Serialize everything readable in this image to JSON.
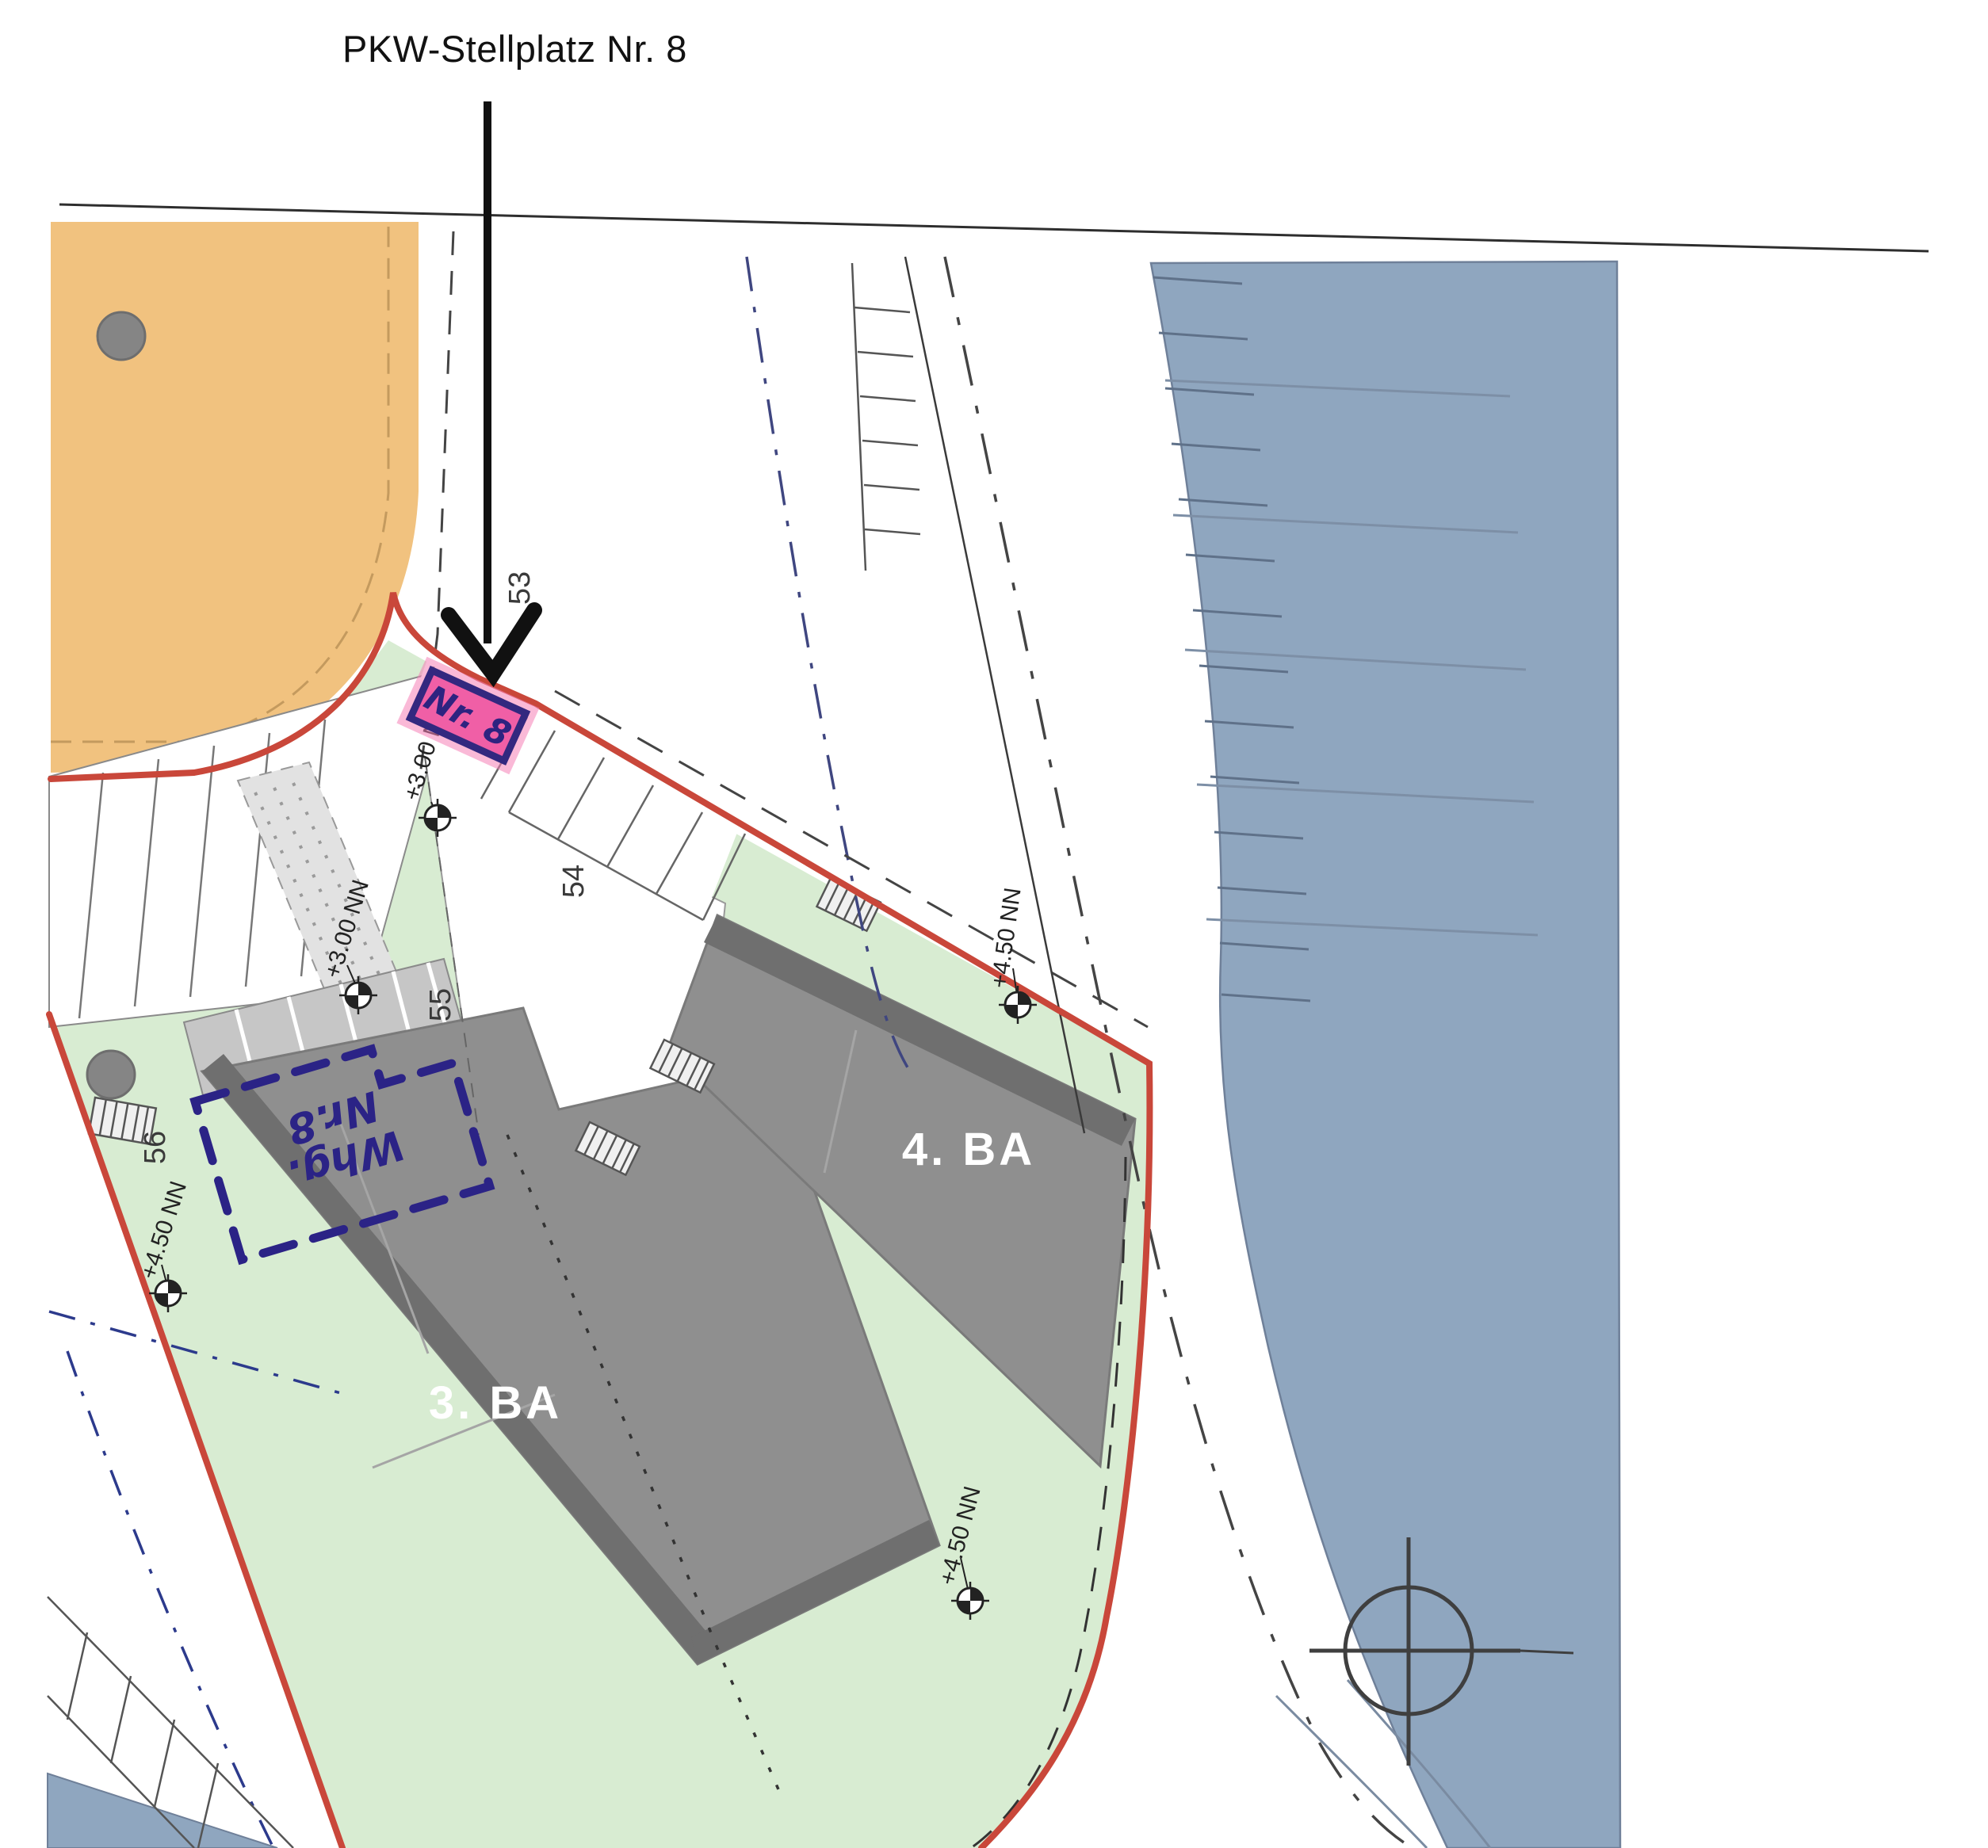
{
  "annotation": {
    "title": "PKW-Stellplatz Nr. 8",
    "stall_label": "Nr. 8",
    "apartment": {
      "line1": "Whg.",
      "line2": "Nr.8"
    }
  },
  "plan": {
    "phases": {
      "ba3": "3. BA",
      "ba4": "4. BA"
    },
    "parcels": {
      "p53": "53",
      "p54": "54",
      "p55": "55",
      "p56": "56"
    },
    "elevations": {
      "e1": "+3.00 NN",
      "e2": "+3.00 NN",
      "e3": "+4.50 NN",
      "e4": "+4.50 NN",
      "e5": "+4.50 NN"
    }
  },
  "colors": {
    "boundary_red": "#c9473a",
    "highlight_pink": "#f05fa6",
    "ink_blue": "#2b2386",
    "water_blue": "#8fa6bf",
    "lawn_green": "#d8ecd2",
    "building_gray": "#8f8f8f",
    "building_edge_gray": "#6f6f6f",
    "plot_orange": "#f1c27f"
  }
}
